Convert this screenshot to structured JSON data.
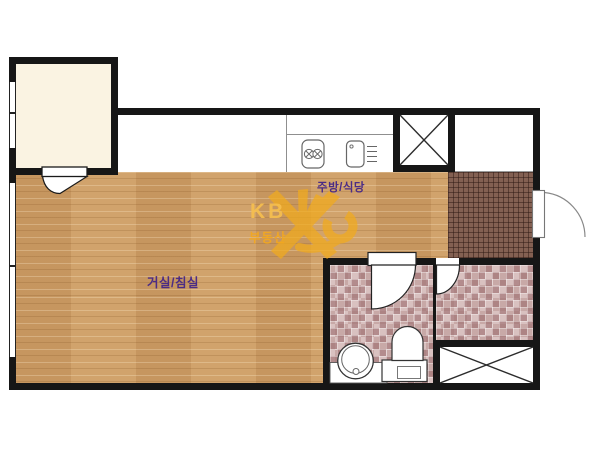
{
  "floorplan": {
    "rooms": {
      "living": {
        "label": "거실/침실"
      },
      "kitchen": {
        "label": "주방/식당"
      }
    },
    "watermark": {
      "brand": "KB",
      "subtitle": "부동산"
    },
    "colors": {
      "wall": "#161616",
      "wood_floor": "#cc9c66",
      "balcony_floor": "#faf3e2",
      "entry_tile": "#836052",
      "bath_tile": "#c8a9a7",
      "label_text": "#4b2c85",
      "watermark_orange": "#f1ab1d"
    },
    "icons": {
      "stove": "stove-icon",
      "sink": "sink-icon",
      "toilet": "toilet-icon",
      "washbasin": "washbasin-icon",
      "door_swing": "door-swing-icon",
      "shaft_cross": "shaft-x-icon",
      "window": "window-icon"
    }
  }
}
